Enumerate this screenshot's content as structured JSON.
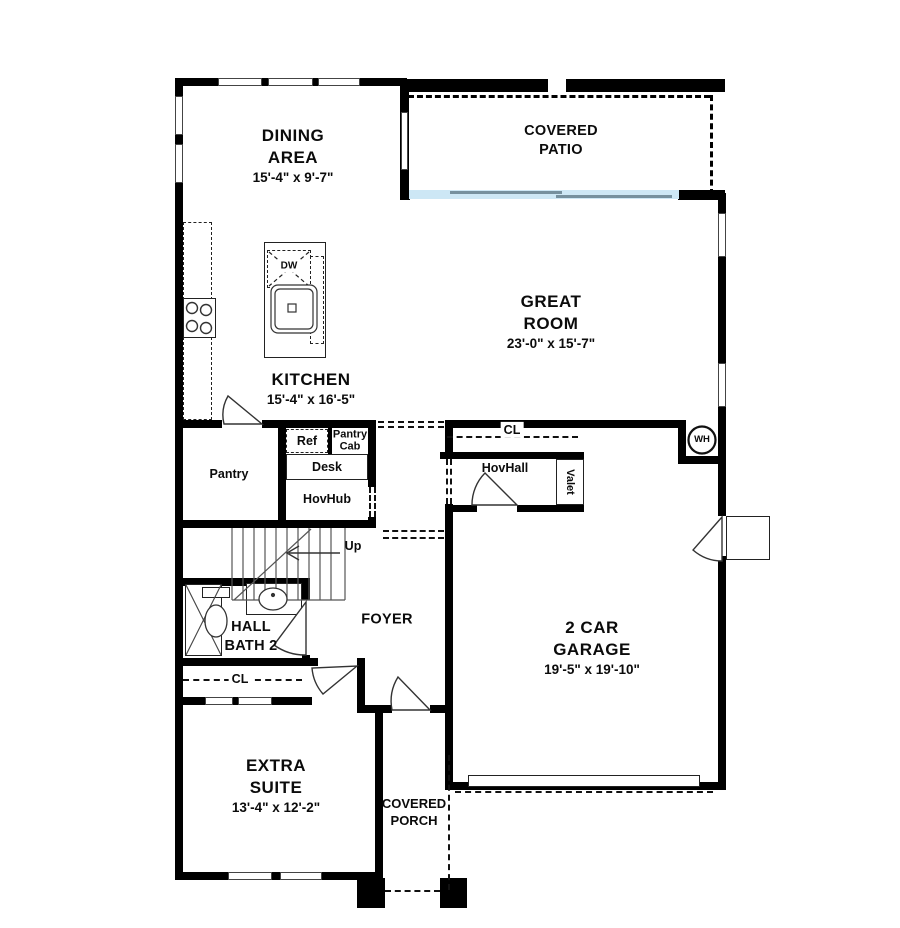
{
  "colors": {
    "wall": "#000000",
    "glass_door": "#cde7f5",
    "glass_panel": "#76909e"
  },
  "rooms": {
    "dining": {
      "line1": "DINING",
      "line2": "AREA",
      "dims": "15'-4\" x 9'-7\""
    },
    "patio": {
      "line1": "COVERED",
      "line2": "PATIO"
    },
    "great": {
      "line1": "GREAT",
      "line2": "ROOM",
      "dims": "23'-0\" x 15'-7\""
    },
    "kitchen": {
      "line1": "KITCHEN",
      "dims": "15'-4\" x 16'-5\""
    },
    "foyer": {
      "line1": "FOYER"
    },
    "bath": {
      "line1": "HALL",
      "line2": "BATH 2"
    },
    "suite": {
      "line1": "EXTRA",
      "line2": "SUITE",
      "dims": "13'-4\" x 12'-2\""
    },
    "porch": {
      "line1": "COVERED",
      "line2": "PORCH"
    },
    "garage": {
      "line1": "2 CAR",
      "line2": "GARAGE",
      "dims": "19'-5\" x 19'-10\""
    },
    "pantry": {
      "line1": "Pantry"
    }
  },
  "fixtures": {
    "dw": "DW",
    "ref": "Ref",
    "pantry_cab1": "Pantry",
    "pantry_cab2": "Cab",
    "desk": "Desk",
    "hovhub": "HovHub",
    "cl_upper": "CL",
    "hovhall": "HovHall",
    "valet": "Valet",
    "wh": "WH",
    "up": "Up",
    "cl_lower": "CL"
  }
}
